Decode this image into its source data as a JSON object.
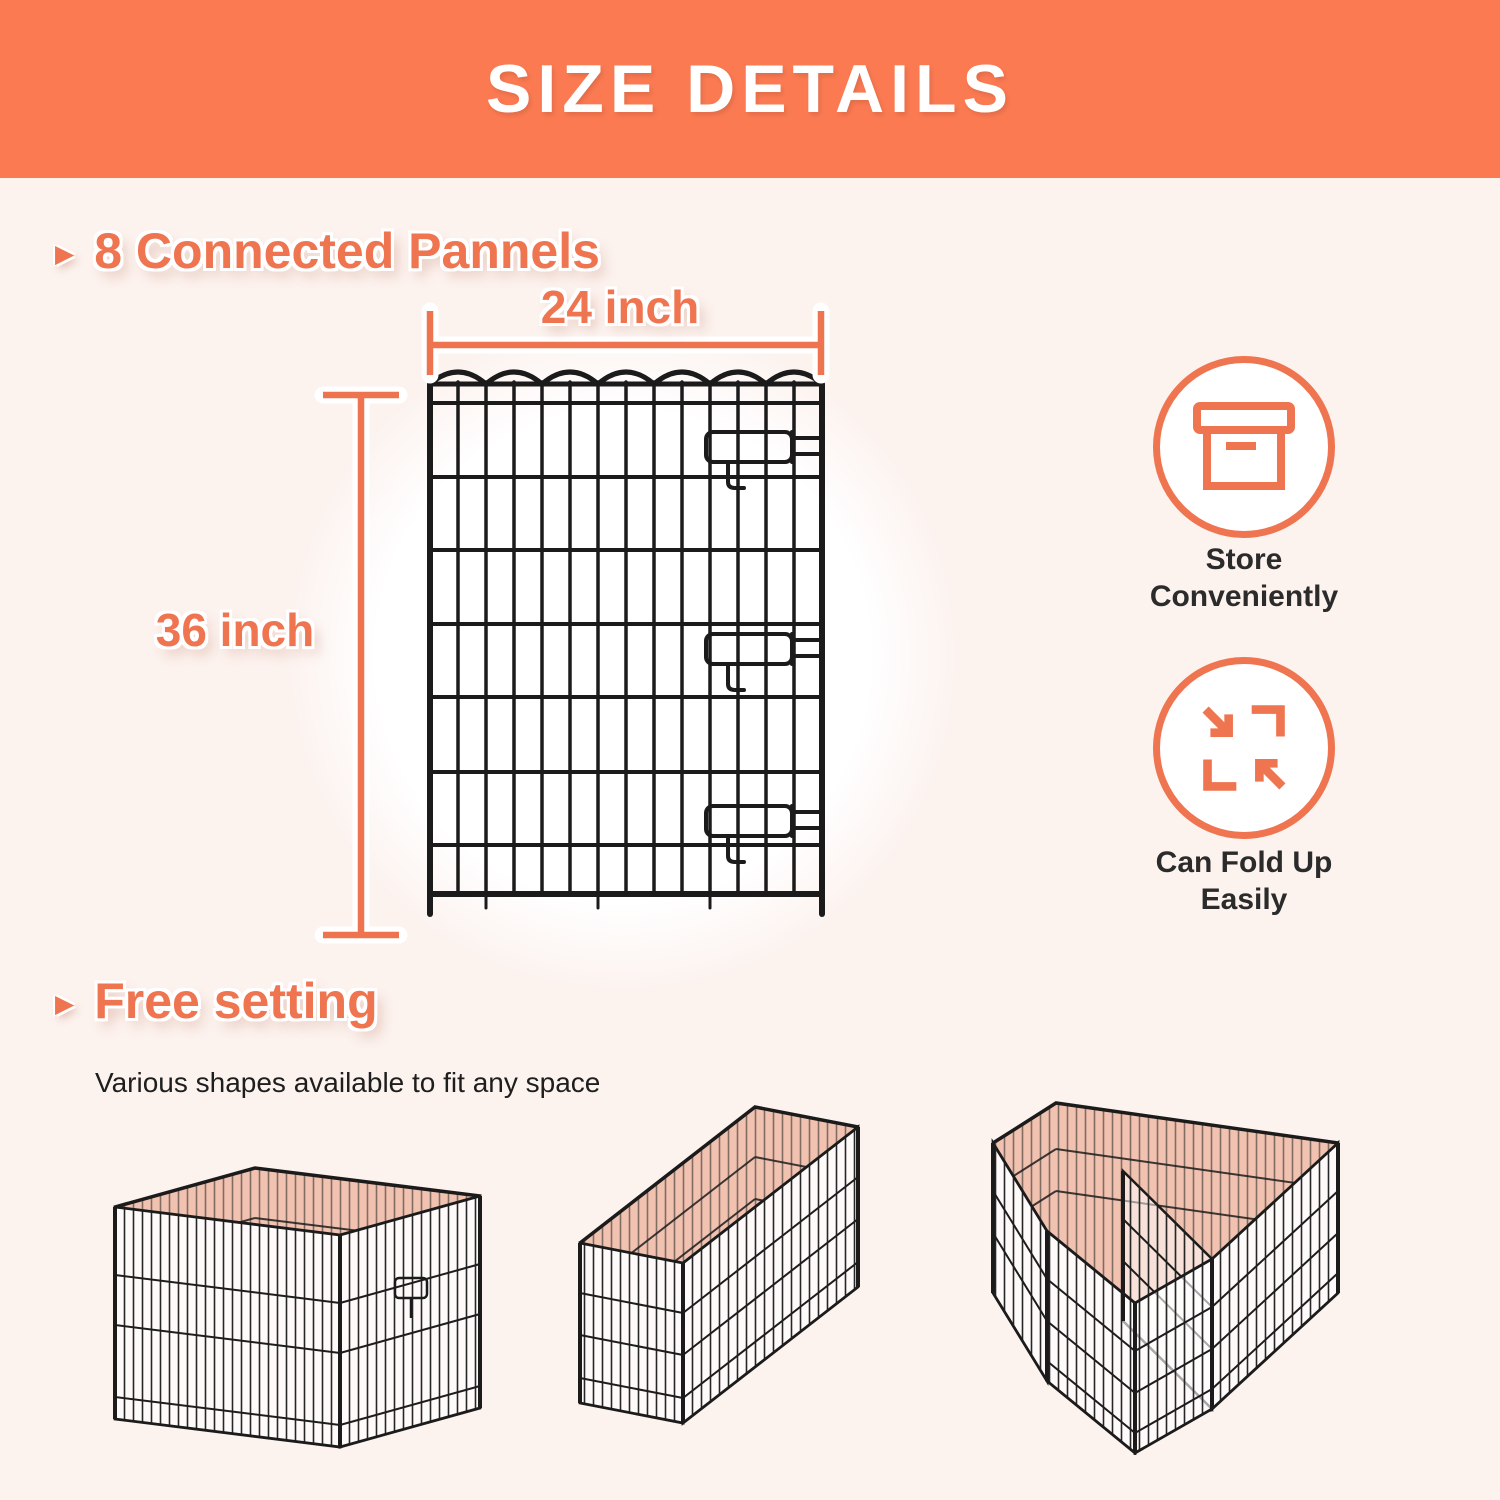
{
  "colors": {
    "header_bg": "#FB7A52",
    "accent_orange": "#EF7450",
    "background": "#FCF2EE",
    "dark_text": "#2B2B2B",
    "wire_black": "#1B1B1B",
    "pen_floor_pink": "#F1C2B0",
    "glow_white": "#FFFFFF"
  },
  "header": {
    "title": "SIZE DETAILS"
  },
  "panel_section": {
    "bullet_glyph": "▶",
    "heading": "8 Connected Pannels",
    "width_label": "24 inch",
    "height_label": "36 inch",
    "image": "wire-panel-front-view"
  },
  "features": [
    {
      "icon": "storage-box-icon",
      "line1": "Store",
      "line2": "Conveniently"
    },
    {
      "icon": "fold-arrows-icon",
      "line1": "Can Fold Up",
      "line2": "Easily"
    }
  ],
  "free_setting_section": {
    "bullet_glyph": "▶",
    "heading": "Free setting",
    "subtext": "Various shapes available to fit any space",
    "shapes": [
      {
        "name": "square-pen"
      },
      {
        "name": "rectangle-pen"
      },
      {
        "name": "l-shape-pen"
      }
    ]
  }
}
